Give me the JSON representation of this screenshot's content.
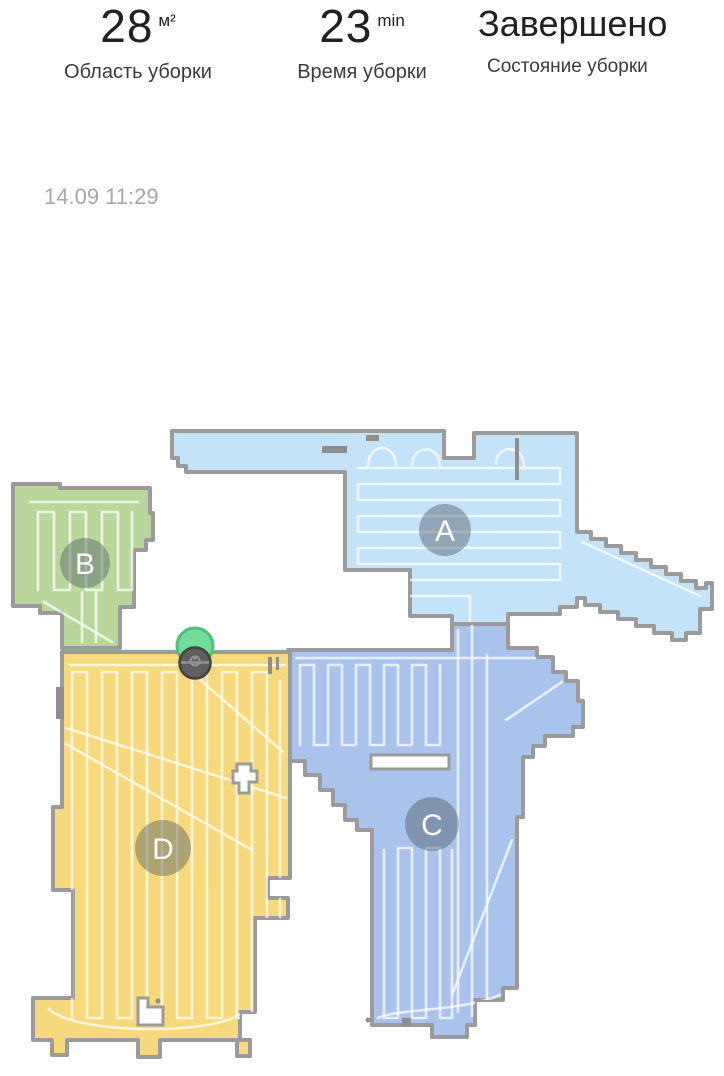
{
  "header": {
    "stats": [
      {
        "value": "28",
        "unit": "м²",
        "label": "Область уборки"
      },
      {
        "value": "23",
        "unit": "min",
        "label": "Время уборки"
      },
      {
        "value": "Завершено",
        "label": "Состояние уборки"
      }
    ],
    "timestamp": "14.09 11:29"
  },
  "map": {
    "rooms": [
      {
        "letter": "A",
        "color": "#c4e2f8"
      },
      {
        "letter": "B",
        "color": "#b9d79b"
      },
      {
        "letter": "C",
        "color": "#a9c3ec"
      },
      {
        "letter": "D",
        "color": "#f6d97b"
      }
    ],
    "wall_color": "#9b9b9b",
    "clean_path_color": "#ffffff",
    "dock": {
      "icon": "dock-icon",
      "color": "#70dd9b",
      "border": "#4fbe7e"
    },
    "robot": {
      "icon": "robot-icon",
      "color": "#5f5f5f",
      "border": "#424242"
    }
  }
}
